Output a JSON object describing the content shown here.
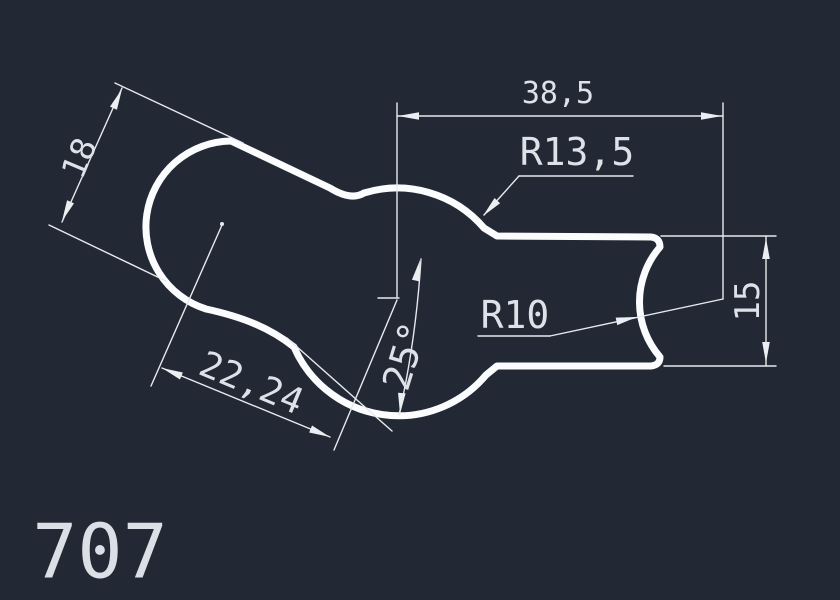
{
  "app": {
    "type": "cad-drawing-view"
  },
  "canvas": {
    "background_color": "#222834",
    "outline_color": "#fbfcfe",
    "dimension_line_color": "#e6eaee",
    "text_color": "#dde2e8"
  },
  "drawing": {
    "title": "707",
    "part_outline": "rounded two-lobe profile with right channel",
    "dimensions": [
      {
        "id": "top-width",
        "kind": "linear",
        "label": "38,5"
      },
      {
        "id": "mid-radius",
        "kind": "radius",
        "label": "R13,5"
      },
      {
        "id": "lobe-width",
        "kind": "linear",
        "label": "18"
      },
      {
        "id": "center-distance",
        "kind": "linear",
        "label": "22,24"
      },
      {
        "id": "axis-angle",
        "kind": "angular",
        "label": "25°"
      },
      {
        "id": "end-radius",
        "kind": "radius",
        "label": "R10"
      },
      {
        "id": "channel-height",
        "kind": "linear",
        "label": "15"
      }
    ]
  }
}
